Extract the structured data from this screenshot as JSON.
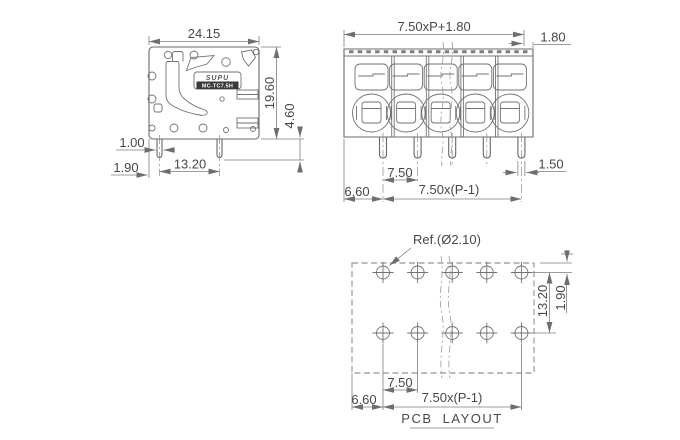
{
  "drawing": {
    "side_view": {
      "brand": "SUPU",
      "model": "MC-TC7.5H",
      "dim_width": "24.15",
      "dim_height": "19.60",
      "dim_pin_length": "4.60",
      "dim_pin_width": "1.00",
      "dim_edge_to_pin": "1.90",
      "dim_pin_spacing": "13.20"
    },
    "front_view": {
      "dim_total_width": "7.50xP+1.80",
      "dim_end_margin": "1.80",
      "dim_pin_width": "1.50",
      "dim_pitch": "7.50",
      "dim_left_margin": "6.60",
      "dim_span": "7.50x(P-1)"
    },
    "pcb_layout": {
      "title": "PCB LAYOUT",
      "hole_note": "Ref.(Ø2.10)",
      "dim_row_spacing": "13.20",
      "dim_row_offset": "1.90",
      "dim_pitch": "7.50",
      "dim_left_margin": "6.60",
      "dim_span": "7.50x(P-1)"
    }
  },
  "colors": {
    "line": "#686868",
    "dimension": "#7d7d7d",
    "text": "#474747",
    "background": "#ffffff"
  }
}
